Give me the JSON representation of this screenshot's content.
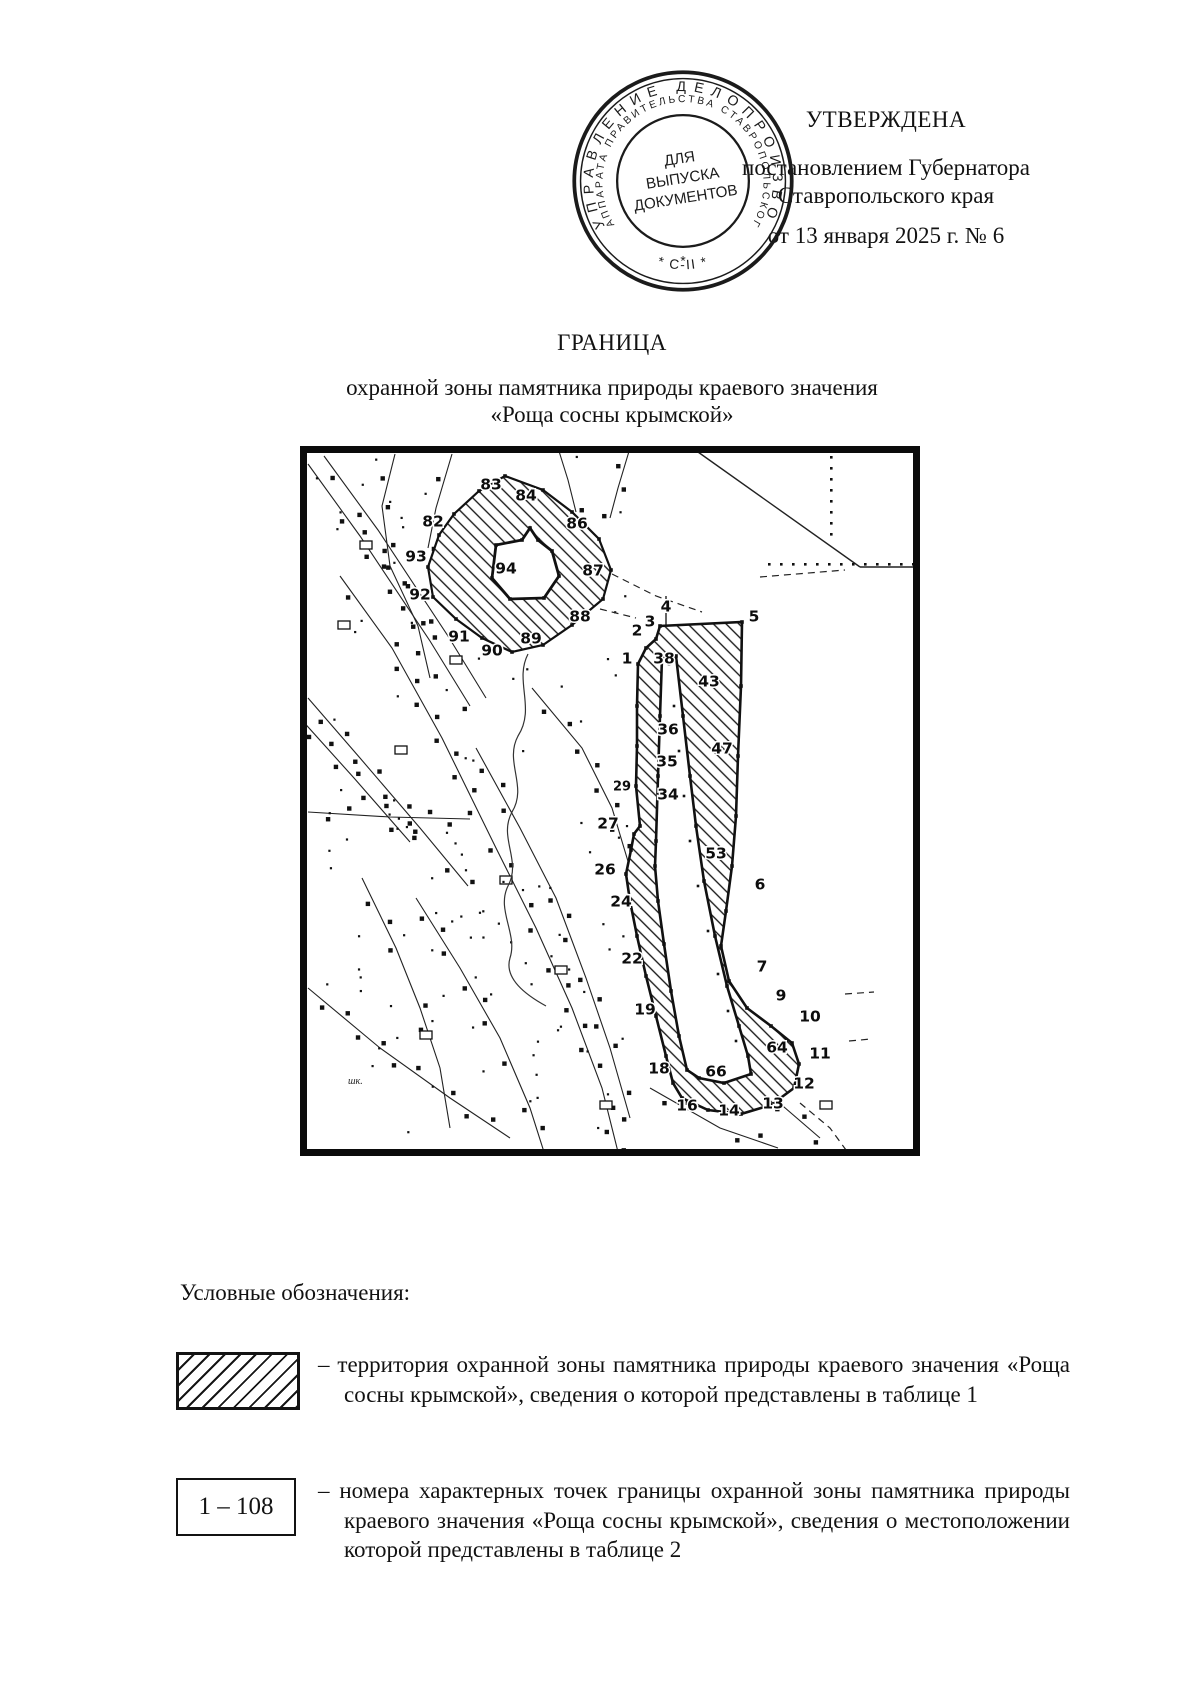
{
  "stamp": {
    "ring_outer": "УПРАВЛЕНИЕ ДЕЛОПРОИЗВОДСТВА",
    "ring_inner": "АППАРАТА ПРАВИТЕЛЬСТВА СТАВРОПОЛЬСКОГО КРАЯ",
    "ring_bottom": "*  С-II  *",
    "ring_bottom2": "*",
    "center_line1": "ДЛЯ",
    "center_line2": "ВЫПУСКА",
    "center_line3": "ДОКУМЕНТОВ"
  },
  "approval": {
    "title": "УТВЕРЖДЕНА",
    "line1": "постановлением Губернатора",
    "line2": "Ставропольского края",
    "line3": "от 13 января 2025 г. № 6"
  },
  "heading": {
    "title": "ГРАНИЦА",
    "subtitle1": "охранной зоны памятника природы краевого значения",
    "subtitle2": "«Роща сосны крымской»"
  },
  "map": {
    "school_label": "шк.",
    "points": [
      {
        "n": "83",
        "x": 191,
        "y": 39
      },
      {
        "n": "84",
        "x": 226,
        "y": 50
      },
      {
        "n": "82",
        "x": 133,
        "y": 76
      },
      {
        "n": "86",
        "x": 277,
        "y": 78
      },
      {
        "n": "93",
        "x": 116,
        "y": 111
      },
      {
        "n": "94",
        "x": 206,
        "y": 123
      },
      {
        "n": "87",
        "x": 293,
        "y": 125
      },
      {
        "n": "92",
        "x": 120,
        "y": 149
      },
      {
        "n": "88",
        "x": 280,
        "y": 171
      },
      {
        "n": "91",
        "x": 159,
        "y": 191
      },
      {
        "n": "89",
        "x": 231,
        "y": 193
      },
      {
        "n": "90",
        "x": 192,
        "y": 205
      },
      {
        "n": "4",
        "x": 366,
        "y": 161
      },
      {
        "n": "3",
        "x": 350,
        "y": 176
      },
      {
        "n": "5",
        "x": 454,
        "y": 171
      },
      {
        "n": "2",
        "x": 337,
        "y": 185
      },
      {
        "n": "1",
        "x": 327,
        "y": 213
      },
      {
        "n": "38",
        "x": 364,
        "y": 213
      },
      {
        "n": "43",
        "x": 409,
        "y": 236
      },
      {
        "n": "36",
        "x": 368,
        "y": 284
      },
      {
        "n": "47",
        "x": 422,
        "y": 303
      },
      {
        "n": "35",
        "x": 367,
        "y": 316
      },
      {
        "n": "34",
        "x": 368,
        "y": 349
      },
      {
        "n": "29",
        "x": 322,
        "y": 341,
        "small": true
      },
      {
        "n": "27",
        "x": 308,
        "y": 378
      },
      {
        "n": "53",
        "x": 416,
        "y": 408
      },
      {
        "n": "26",
        "x": 305,
        "y": 424
      },
      {
        "n": "6",
        "x": 460,
        "y": 439
      },
      {
        "n": "24",
        "x": 321,
        "y": 456
      },
      {
        "n": "22",
        "x": 332,
        "y": 513
      },
      {
        "n": "7",
        "x": 462,
        "y": 521
      },
      {
        "n": "19",
        "x": 345,
        "y": 564
      },
      {
        "n": "9",
        "x": 481,
        "y": 550
      },
      {
        "n": "10",
        "x": 510,
        "y": 571
      },
      {
        "n": "64",
        "x": 477,
        "y": 602
      },
      {
        "n": "11",
        "x": 520,
        "y": 608
      },
      {
        "n": "18",
        "x": 359,
        "y": 623
      },
      {
        "n": "66",
        "x": 416,
        "y": 626
      },
      {
        "n": "12",
        "x": 504,
        "y": 638
      },
      {
        "n": "13",
        "x": 473,
        "y": 658
      },
      {
        "n": "16",
        "x": 387,
        "y": 660
      },
      {
        "n": "14",
        "x": 429,
        "y": 665
      }
    ]
  },
  "legend": {
    "heading": "Условные обозначения:",
    "items": [
      {
        "swatch": "hatched-area",
        "text": "– территория охранной зоны памятника природы краевого значения «Роща сосны крымской», сведения о которой представлены в таблице 1"
      },
      {
        "swatch_label": "1 – 108",
        "text": "– номера характерных точек границы охранной зоны памятника природы краевого значения «Роща сосны крымской», сведения о местоположении которой представлены в таблице 2"
      }
    ]
  }
}
